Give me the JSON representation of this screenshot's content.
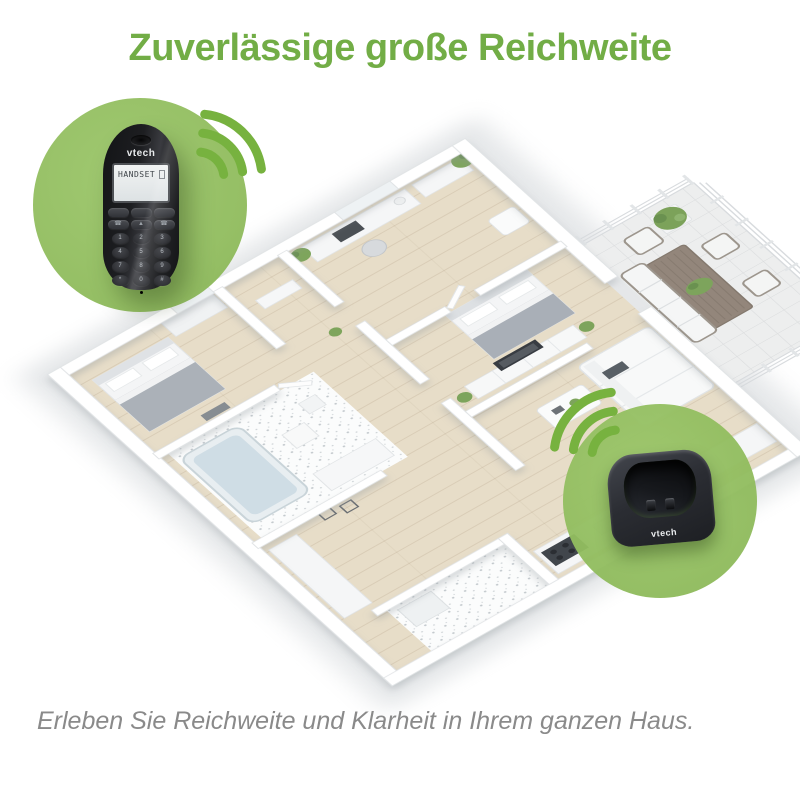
{
  "title": {
    "text": "Zuverlässige große Reichweite",
    "color": "#72ad46"
  },
  "caption": {
    "text": "Erleben Sie Reichweite und Klarheit in Ihrem ganzen Haus.",
    "color": "#8a8a8a"
  },
  "theme": {
    "background": "#ffffff",
    "callout_circle_green": "#98c167",
    "signal_wave_green": "#77b23f",
    "floor_wood": "#e7ddc8",
    "wall_white": "#ffffff",
    "product_black": "#1b1c1f"
  },
  "handset_callout": {
    "brand": "vtech",
    "display_text": "HANDSET",
    "nav_keys": [
      "",
      "",
      "",
      "☎",
      "▲",
      "☎"
    ],
    "keypad": [
      "1",
      "2",
      "3",
      "4",
      "5",
      "6",
      "7",
      "8",
      "9",
      "*",
      "0",
      "#"
    ]
  },
  "base_callout": {
    "brand": "vtech"
  }
}
